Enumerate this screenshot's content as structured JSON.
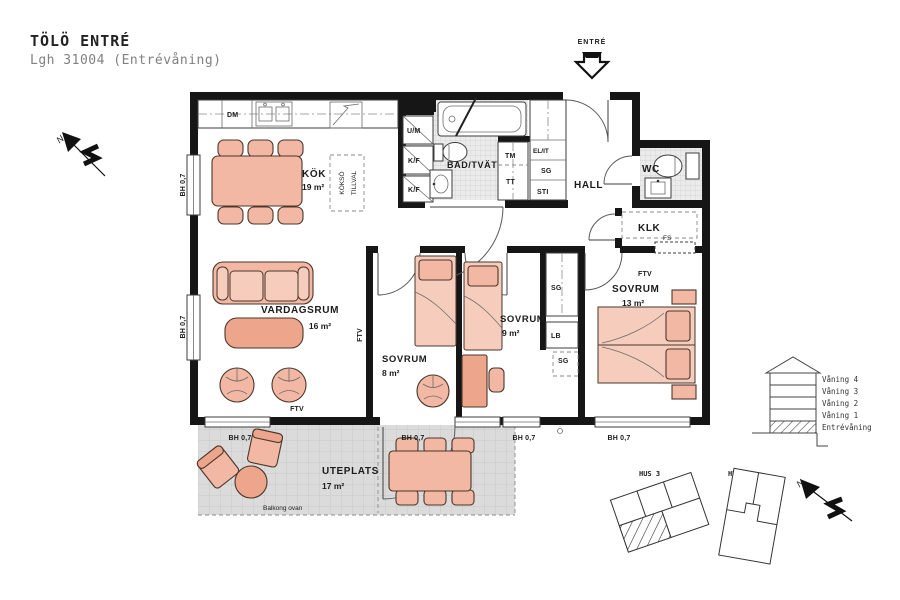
{
  "title": "TÖLÖ ENTRÉ",
  "subtitle": "Lgh 31004 (Entrévåning)",
  "entry": {
    "label": "ENTRÉ"
  },
  "compass": {
    "north": "N"
  },
  "rooms": {
    "kok": {
      "name": "KÖK",
      "area": "19 m²"
    },
    "vardagsrum": {
      "name": "VARDAGSRUM",
      "area": "16 m²"
    },
    "sovrum8": {
      "name": "SOVRUM",
      "area": "8 m²"
    },
    "sovrum9": {
      "name": "SOVRUM",
      "area": "9 m²"
    },
    "sovrum13": {
      "name": "SOVRUM",
      "area": "13 m²"
    },
    "bad": {
      "name": "BAD/TVÄTT"
    },
    "wc": {
      "name": "WC"
    },
    "hall": {
      "name": "HALL"
    },
    "klk": {
      "name": "KLK"
    },
    "uteplats": {
      "name": "UTEPLATS",
      "area": "17 m²"
    }
  },
  "fixtures": {
    "dm": "DM",
    "um": "U/M",
    "kf": "K/F",
    "tm": "TM",
    "tt": "TT",
    "elit": "EL/IT",
    "sg": "SG",
    "sti": "STI",
    "fs": "FS",
    "lb": "LB",
    "ftv": "FTV",
    "kokso_line1": "KÖKSÖ",
    "kokso_line2": "TILLVAL"
  },
  "annotations": {
    "bh": "BH 0,7",
    "balkong": "Balkong ovan"
  },
  "section_legend": {
    "floors": [
      "Våning 4",
      "Våning 3",
      "Våning 2",
      "Våning 1",
      "Entrévåning"
    ]
  },
  "site": {
    "hus3": "HUS 3",
    "hus4": "HUS 4"
  },
  "colors": {
    "wall": "#161616",
    "furniture": "#f2b8a3",
    "furniture_light": "#f6cdbc",
    "furniture_dark": "#eda68c",
    "wet_floor": "#ebebeb",
    "patio_floor": "#dbdbdb"
  }
}
